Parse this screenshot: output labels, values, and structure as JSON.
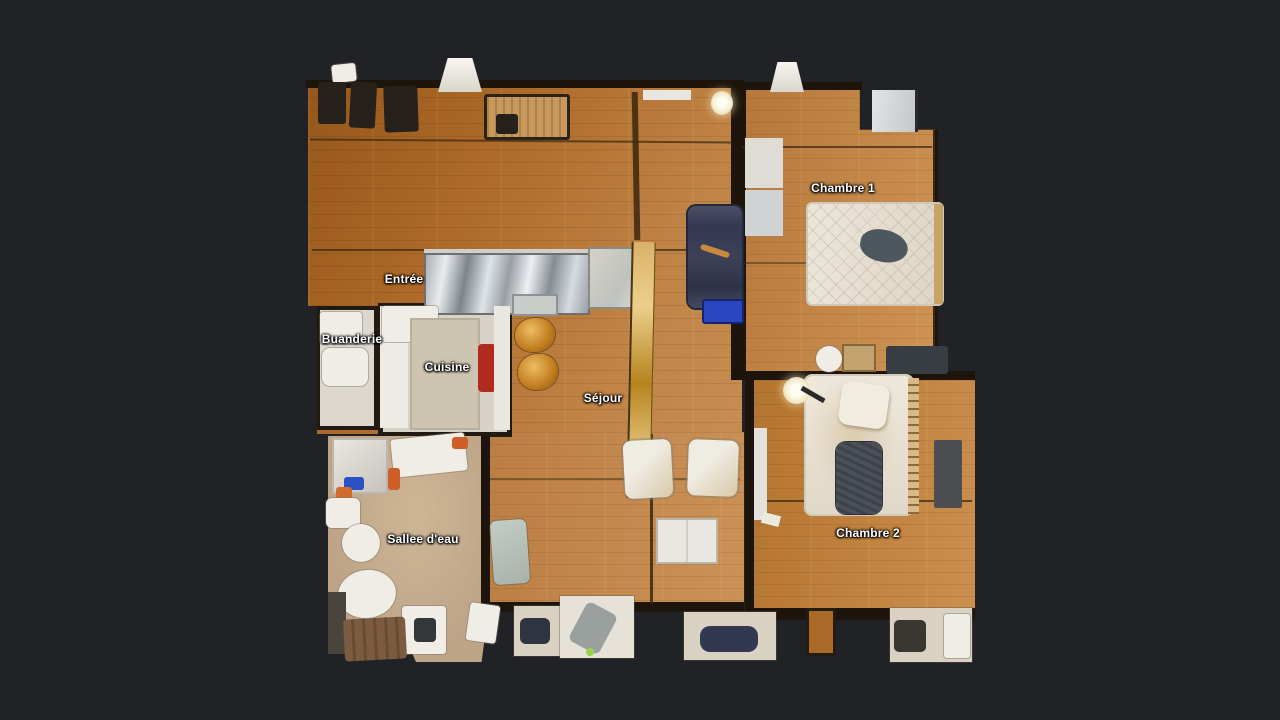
{
  "rooms": [
    {
      "id": "chambre-1",
      "label": "Chambre 1",
      "x": 843,
      "y": 188
    },
    {
      "id": "entree",
      "label": "Entrée",
      "x": 404,
      "y": 279
    },
    {
      "id": "buanderie",
      "label": "Buanderie",
      "x": 352,
      "y": 339
    },
    {
      "id": "cuisine",
      "label": "Cuisine",
      "x": 447,
      "y": 367
    },
    {
      "id": "sejour",
      "label": "Séjour",
      "x": 603,
      "y": 398
    },
    {
      "id": "salle-deau",
      "label": "Sallee d'eau",
      "x": 423,
      "y": 539
    },
    {
      "id": "chambre-2",
      "label": "Chambre 2",
      "x": 868,
      "y": 533
    }
  ],
  "palette": {
    "background": "#212226",
    "wood_dark": "#a9651f",
    "wood_mid": "#c08448",
    "wood_light": "#cd8f4e",
    "wall": "#1d150b",
    "kitchen_floor": "#d8d3c9",
    "bath_floor": "#c2ab8c",
    "mattress": "#e7e1d5",
    "sofa": "#3b3f55",
    "crate_blue": "#2a46c0",
    "label_text": "#ffffff"
  }
}
